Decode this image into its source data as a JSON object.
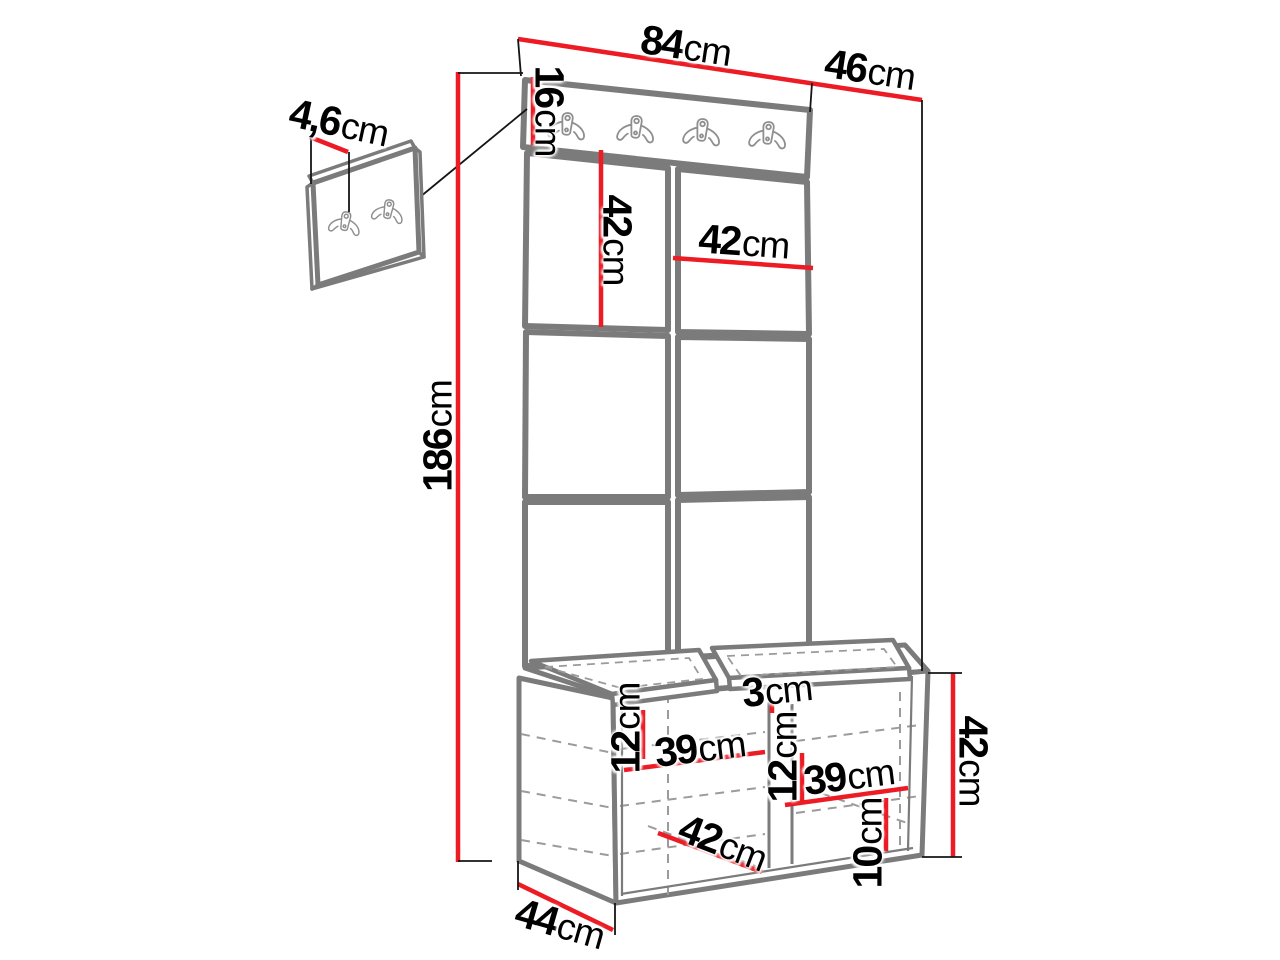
{
  "page": {
    "background": "#ffffff"
  },
  "colors": {
    "dimension_line_red": "#ec1b24",
    "furniture_outline_gray": "#7b7b7b",
    "hidden_line_gray": "#9b9b9b",
    "extension_line_black": "#151515",
    "label_text": "#000000"
  },
  "diagram": {
    "type": "furniture-dimension-drawing",
    "counts": {
      "rail_hooks": 4,
      "wall_panel_hooks": 2,
      "visible_upholstered_panels": 6,
      "bench_seat_cushions": 2
    },
    "dimensions": {
      "total_width": {
        "value": "84",
        "unit": "cm"
      },
      "total_depth": {
        "value": "46",
        "unit": "cm"
      },
      "hook_rail_height": {
        "value": "16",
        "unit": "cm"
      },
      "wall_panel_thickness": {
        "value": "4,6",
        "unit": "cm"
      },
      "upholstered_panel_height": {
        "value": "42",
        "unit": "cm"
      },
      "upholstered_panel_width": {
        "value": "42",
        "unit": "cm"
      },
      "total_height": {
        "value": "186",
        "unit": "cm"
      },
      "left_shelf_clearance": {
        "value": "12",
        "unit": "cm"
      },
      "left_shelf_width": {
        "value": "39",
        "unit": "cm"
      },
      "seat_cushion_thickness": {
        "value": "3",
        "unit": "cm"
      },
      "right_shelf_clearance": {
        "value": "12",
        "unit": "cm"
      },
      "right_shelf_width": {
        "value": "39",
        "unit": "cm"
      },
      "bench_height": {
        "value": "42",
        "unit": "cm"
      },
      "bottom_clearance": {
        "value": "10",
        "unit": "cm"
      },
      "bench_inner_depth": {
        "value": "42",
        "unit": "cm"
      },
      "bench_depth": {
        "value": "44",
        "unit": "cm"
      }
    }
  }
}
